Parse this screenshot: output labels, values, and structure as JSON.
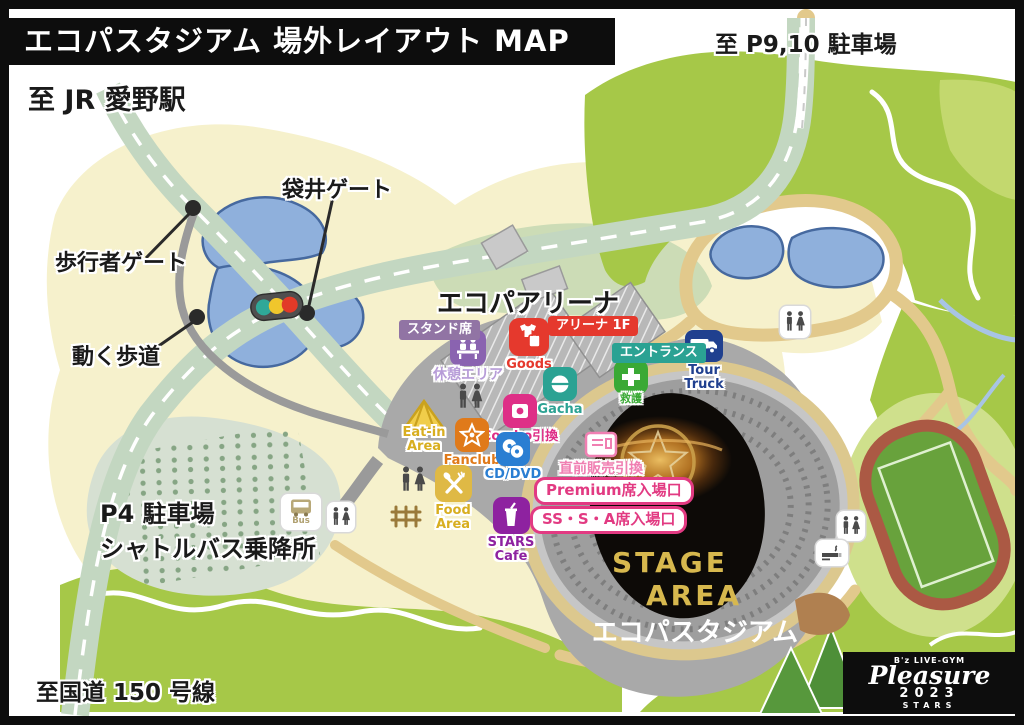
{
  "title": "エコパスタジアム 場外レイアウト MAP",
  "directions": {
    "to_p910": "至 P9,10 駐車場",
    "to_jr": "至 JR 愛野駅",
    "to_route150": "至国道 150 号線"
  },
  "map_labels": {
    "fukuroi_gate": "袋井ゲート",
    "pedestrian_gate": "歩行者ゲート",
    "moving_walkway": "動く歩道",
    "p4_parking": "P4 駐車場",
    "p4_shuttle": "シャトルバス乗降所",
    "arena": "エコパアリーナ",
    "stadium": "エコパスタジアム"
  },
  "stage": {
    "line1": "STAGE",
    "line2": "AREA"
  },
  "badges": {
    "stand_seats": "スタンド席",
    "arena_1f": "アリーナ 1F",
    "entrance": "エントランス",
    "premium_entry": "Premium席入場口",
    "ssa_entry": "SS・S・A席入場口",
    "last_minute": "直前販売引換"
  },
  "pois": {
    "rest_area": "休憩エリア",
    "goods": "Goods",
    "gacha": "Gacha",
    "first_aid": "救護",
    "combo": "Combo引換",
    "eat_in": "Eat-in Area",
    "fanclub": "Fanclub",
    "cd_dvd": "CD/DVD",
    "food_area": "Food Area",
    "stars_cafe": "STARS Cafe",
    "tour_truck": "Tour Truck",
    "bus": "Bus"
  },
  "logo": {
    "brand": "B'z LIVE-GYM",
    "name": "Pleasure",
    "year": "2023",
    "sub": "STARS"
  },
  "icon_names": [
    "restroom-icon",
    "smoking-area-icon",
    "traffic-light-icon",
    "bus-icon",
    "truck-icon",
    "tent-icon",
    "star-icon",
    "disc-icon",
    "capsule-icon",
    "tshirt-bag-icon",
    "cross-icon",
    "cup-icon",
    "fork-spoon-icon",
    "bento-icon",
    "ticket-machine-icon",
    "bench-icon",
    "fence-icon"
  ],
  "colors": {
    "red": "#e5392d",
    "teal": "#2ba293",
    "aid_green": "#3aa935",
    "stand_purple": "#9174a4",
    "rest_purple": "#8a63b0",
    "rest_label": "#b79cd8",
    "magenta": "#de2f87",
    "orange": "#e07a1a",
    "blue": "#2a7ed2",
    "gold": "#dfb945",
    "tent_yellow": "#f0cd4a",
    "cafe_purple": "#8e22a0",
    "navy": "#20408f",
    "pink": "#f07fb2",
    "gate_pink": "#e23a82",
    "stage_gold": "#d7b84e",
    "pond_blue": "#8fb0dc",
    "map_green": "#a6c848",
    "cream": "#f6f1cc",
    "plaza_gray": "#a9a9a9"
  }
}
